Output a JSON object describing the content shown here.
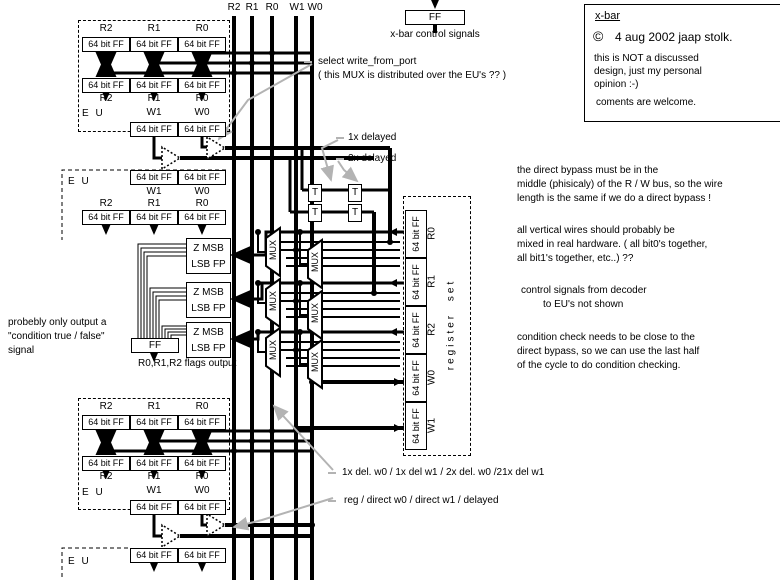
{
  "bus": {
    "r2": "R2",
    "r1": "R1",
    "r0": "R0",
    "w1": "W1",
    "w0": "W0"
  },
  "control": {
    "ff": "FF",
    "caption": "x-bar control signals"
  },
  "title_box": {
    "name": "x-bar",
    "copyright_symbol": "©",
    "copyright_text": "4 aug 2002 jaap stolk.",
    "note_line1": "this is NOT a discussed",
    "note_line2": "design, just my personal",
    "note_line3": "opinion :-)",
    "welcome": "coments are welcome."
  },
  "labels": {
    "ff_cell": "64 bit FF",
    "mux": "MUX",
    "delay_t": "T",
    "eu": "E U",
    "z_top": "Z MSB",
    "z_bottom": "LSB FP",
    "flags_ff": "FF",
    "r2": "R2",
    "r1": "R1",
    "r0": "R0",
    "w1": "W1",
    "w0": "W0"
  },
  "register_set": {
    "caption": "register set",
    "row_r0": "R0",
    "row_r1": "R1",
    "row_r2": "R2",
    "row_w0": "W0",
    "row_w1": "W1"
  },
  "annotations": {
    "select_write_line1": "select write_from_port",
    "select_write_line2": "( this MUX is distributed over the EU's ?? )",
    "delayed_1x": "1x delayed",
    "delayed_2x": "2x delayed",
    "left_line1": "probebly only output a",
    "left_line2": "\"condition true / false\"",
    "left_line3": "signal",
    "flags_output": "R0,R1,R2 flags output",
    "bottom_line1": "1x del. w0 / 1x del w1 / 2x del. w0 /21x del w1",
    "bottom_line2": "reg / direct w0 / direct w1 / delayed"
  },
  "notes": {
    "bypass_1": "the direct bypass must be in the",
    "bypass_2": "middle (phisicaly)  of the R / W bus, so the wire",
    "bypass_3": "length is the same if we do a direct bypass !",
    "wires_1": "all vertical wires should probably be",
    "wires_2": "mixed in real hardware. ( all bit0's together,",
    "wires_3": "all bit1's together, etc..)  ??",
    "control_1": "control signals from decoder",
    "control_2": "to EU's not shown",
    "condition_1": "condition check needs to be close to the",
    "condition_2": "direct bypass, so we can use the last half",
    "condition_3": "of the cycle to do condition checking."
  }
}
